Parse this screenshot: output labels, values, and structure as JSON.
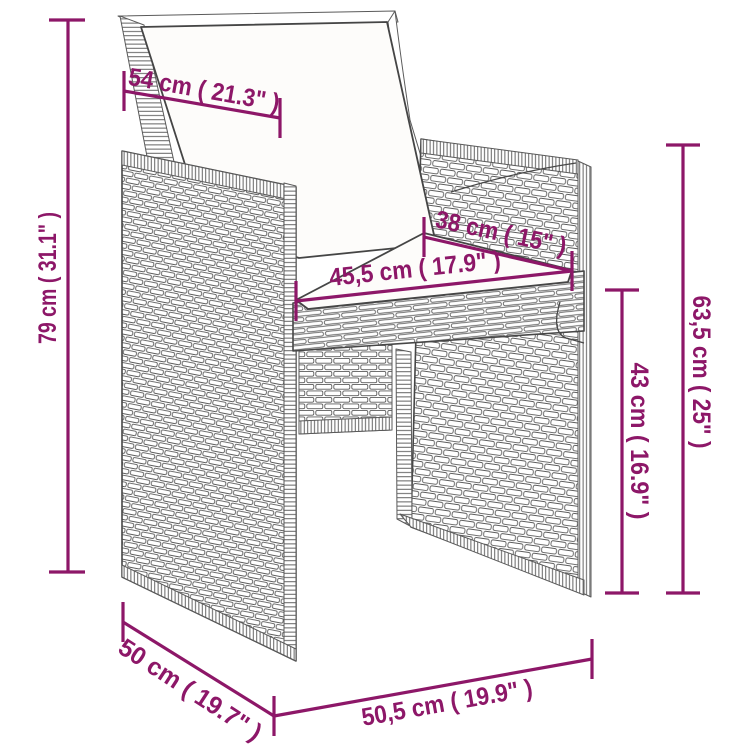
{
  "page": {
    "background": "#ffffff",
    "accent_color": "#8d1768",
    "artwork_line_color": "#474747"
  },
  "diagram": {
    "type": "product-dimension-diagram",
    "subject": "poly-rattan-garden-armchair-with-cushions",
    "dimensions": [
      {
        "id": "backrest-width",
        "label": "54 cm ( 21.3\" )",
        "cm": "54",
        "inches": "21.3"
      },
      {
        "id": "overall-height",
        "label": "79 cm ( 31.1\" )",
        "cm": "79",
        "inches": "31.1"
      },
      {
        "id": "seat-depth",
        "label": "38 cm ( 15\" )",
        "cm": "38",
        "inches": "15"
      },
      {
        "id": "seat-width",
        "label": "45,5 cm ( 17.9\" )",
        "cm": "45,5",
        "inches": "17.9"
      },
      {
        "id": "armrest-height",
        "label": "63,5 cm ( 25\" )",
        "cm": "63,5",
        "inches": "25"
      },
      {
        "id": "seat-height",
        "label": "43 cm ( 16.9\" )",
        "cm": "43",
        "inches": "16.9"
      },
      {
        "id": "overall-depth",
        "label": "50 cm ( 19.7\" )",
        "cm": "50",
        "inches": "19.7"
      },
      {
        "id": "overall-width",
        "label": "50,5 cm ( 19.9\" )",
        "cm": "50,5",
        "inches": "19.9"
      }
    ]
  }
}
